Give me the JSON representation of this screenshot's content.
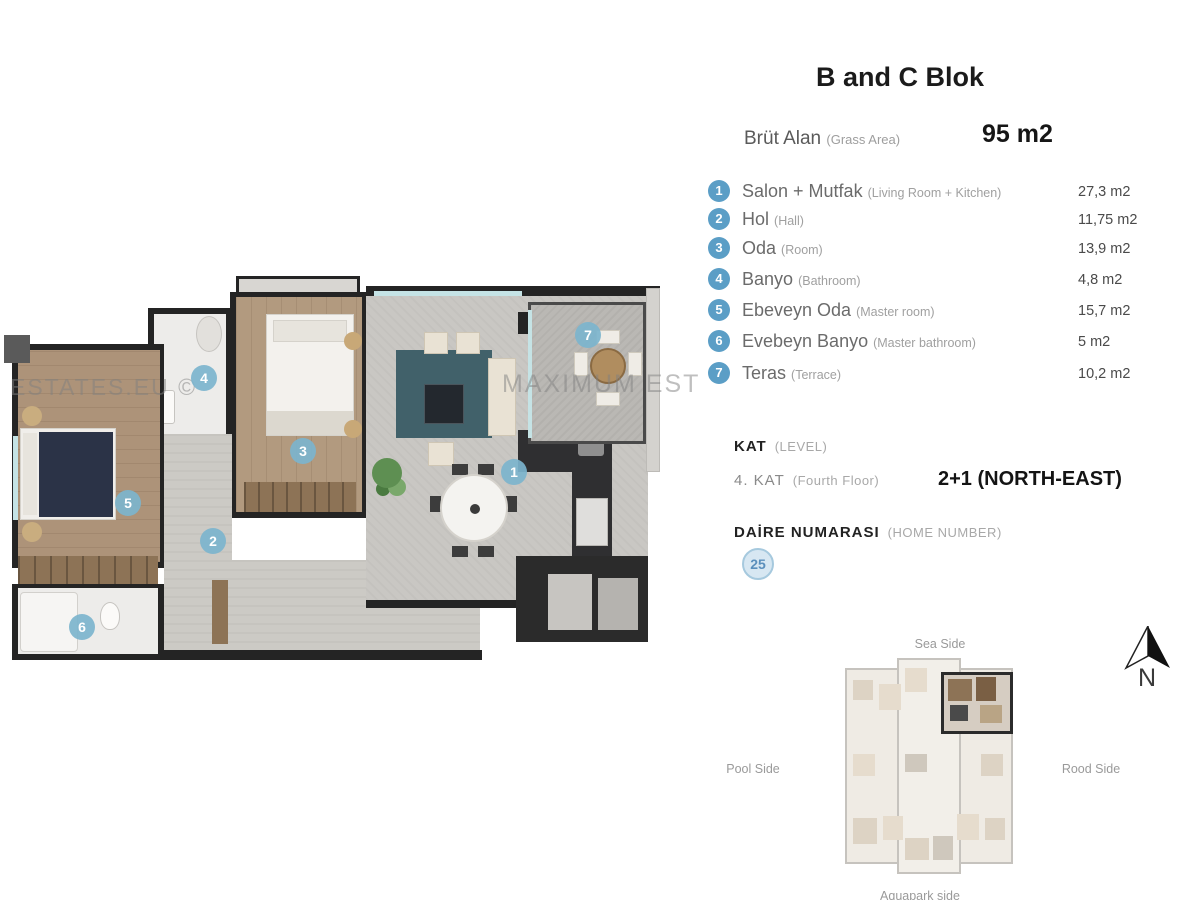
{
  "title": "B and C Blok",
  "gross": {
    "label_tr": "Brüt Alan",
    "label_en": "(Grass Area)",
    "value": "95 m2"
  },
  "legend": [
    {
      "num": "1",
      "name_tr": "Salon + Mutfak",
      "name_en": "(Living Room + Kitchen)",
      "area": "27,3 m2"
    },
    {
      "num": "2",
      "name_tr": "Hol",
      "name_en": "(Hall)",
      "area": "11,75 m2"
    },
    {
      "num": "3",
      "name_tr": "Oda",
      "name_en": "(Room)",
      "area": "13,9 m2"
    },
    {
      "num": "4",
      "name_tr": "Banyo",
      "name_en": "(Bathroom)",
      "area": "4,8 m2"
    },
    {
      "num": "5",
      "name_tr": "Ebeveyn Oda",
      "name_en": "(Master room)",
      "area": "15,7 m2"
    },
    {
      "num": "6",
      "name_tr": "Evebeyn Banyo",
      "name_en": "(Master bathroom)",
      "area": "5 m2"
    },
    {
      "num": "7",
      "name_tr": "Teras",
      "name_en": "(Terrace)",
      "area": "10,2 m2"
    }
  ],
  "level": {
    "label_tr": "KAT",
    "label_en": "(LEVEL)",
    "line_tr": "4. KAT",
    "line_en": "(Fourth Floor)",
    "type": "2+1 (NORTH-EAST)"
  },
  "home": {
    "label_tr": "DAİRE NUMARASI",
    "label_en": "(HOME NUMBER)",
    "value": "25"
  },
  "plan": {
    "badges": [
      "1",
      "2",
      "3",
      "4",
      "5",
      "6",
      "7"
    ],
    "watermark_left": "ESTATES.EU ©",
    "watermark_right": "MAXIMUM EST"
  },
  "site": {
    "sea": "Sea Side",
    "pool": "Pool Side",
    "road": "Rood Side",
    "bottom": "Aquapark side",
    "north": "N"
  },
  "colors": {
    "legend_badge": "#5b9ec6",
    "plan_badge": "#7cb4cd",
    "wall": "#242424",
    "wood_floor": "#b29a7f",
    "rug": "#41616a",
    "accent_glass": "#c5e3e5"
  }
}
